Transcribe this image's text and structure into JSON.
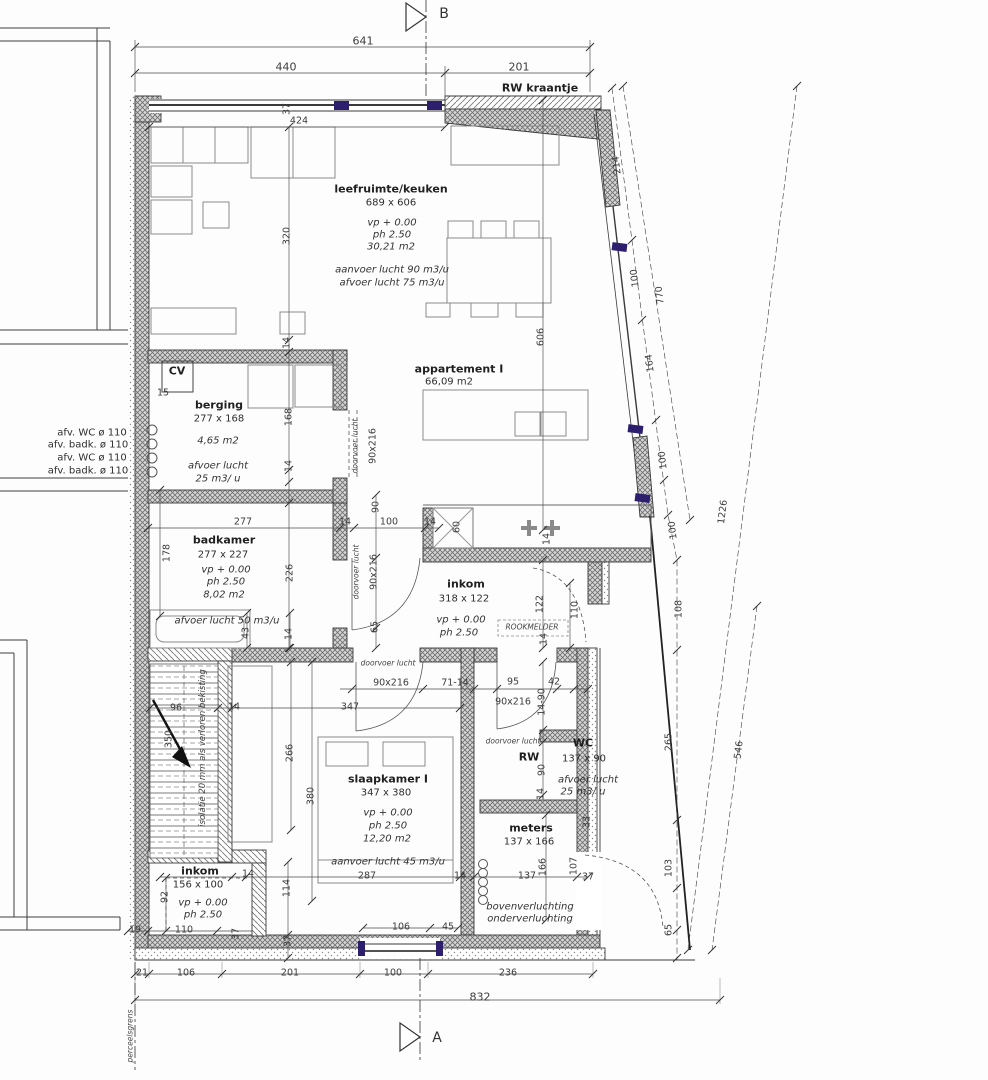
{
  "drawing": {
    "section_marker_top": "B",
    "section_marker_bottom": "A",
    "colors": {
      "accent_window": "#2d1f6e",
      "line": "#3a3a3a",
      "wall_hatch": "#9a9a9a"
    }
  },
  "rooms": {
    "leefruimte_keuken": {
      "title": "leefruimte/keuken",
      "size": "689 x 606",
      "vp": "vp + 0.00",
      "ph": "ph 2.50",
      "area": "30,21 m2",
      "supply": "aanvoer lucht 90 m3/u",
      "extract": "afvoer lucht 75 m3/u"
    },
    "appartement": {
      "title": "appartement I",
      "area": "66,09 m2"
    },
    "berging": {
      "title": "berging",
      "size": "277 x 168",
      "area": "4,65 m2",
      "extract1": "afvoer lucht",
      "extract2": "25 m3/ u",
      "cv": "CV",
      "cv_dim": "15"
    },
    "badkamer": {
      "title": "badkamer",
      "size": "277 x 227",
      "vp": "vp + 0.00",
      "ph": "ph 2.50",
      "area": "8,02 m2",
      "extract": "afvoer lucht 50 m3/u"
    },
    "inkom": {
      "title": "inkom",
      "size": "318 x 122",
      "vp": "vp + 0.00",
      "ph": "ph 2.50",
      "smoke_detector": "ROOKMELDER"
    },
    "slaapkamer": {
      "title": "slaapkamer I",
      "size": "347 x 380",
      "vp": "vp + 0.00",
      "ph": "ph 2.50",
      "area": "12,20 m2",
      "supply": "aanvoer lucht 45 m3/u"
    },
    "wc": {
      "title": "WC",
      "size": "137 x 90",
      "rw": "RW",
      "extract1": "afvoer lucht",
      "extract2": "25 m3/ u"
    },
    "meters": {
      "title": "meters",
      "size": "137 x 166"
    },
    "inkom_beneden": {
      "title": "inkom",
      "size": "156 x 100",
      "vp": "vp + 0.00",
      "ph": "ph 2.50"
    },
    "ventilation_note": [
      "bovenverluchting",
      "onderverluchting"
    ]
  },
  "notes": {
    "rw_kraantje": "RW kraantje",
    "stair_insulation": "isolatie 20 mm als verloren bekisting",
    "boundary": "perceelsgrens",
    "pipes": [
      "afv. WC ø 110",
      "afv. badk. ø 110",
      "afv. WC ø 110",
      "afv. badk. ø 110"
    ]
  },
  "labels": [
    {
      "name": "section-b-letter",
      "text": "B",
      "x": 444,
      "y": 14,
      "cls": "mark"
    },
    {
      "name": "dim-641",
      "text": "641",
      "x": 363,
      "y": 42,
      "cls": "dim big"
    },
    {
      "name": "dim-440",
      "text": "440",
      "x": 286,
      "y": 68,
      "cls": "dim big"
    },
    {
      "name": "dim-201-top",
      "text": "201",
      "x": 519,
      "y": 68,
      "cls": "dim big"
    },
    {
      "name": "note-rw-kraantje",
      "text": "RW kraantje",
      "x": 540,
      "y": 89,
      "cls": "b"
    },
    {
      "name": "dim-37-topleft",
      "text": "37",
      "x": 288,
      "y": 109,
      "cls": "dim rot"
    },
    {
      "name": "dim-424",
      "text": "424",
      "x": 299,
      "y": 122,
      "cls": "dim"
    },
    {
      "name": "dim-320",
      "text": "320",
      "x": 288,
      "y": 236,
      "cls": "dim rot"
    },
    {
      "name": "dim-14-a",
      "text": "14",
      "x": 288,
      "y": 343,
      "cls": "dim rot"
    },
    {
      "name": "dim-606",
      "text": "606",
      "x": 542,
      "y": 337,
      "cls": "dim rot"
    },
    {
      "name": "room-leefruimte-title",
      "text": "leefruimte/keuken",
      "x": 391,
      "y": 190,
      "cls": "b"
    },
    {
      "name": "room-leefruimte-size",
      "text": "689 x 606",
      "x": 391,
      "y": 203,
      "cls": "n"
    },
    {
      "name": "room-leefruimte-vp",
      "text": "vp + 0.00",
      "x": 392,
      "y": 223,
      "cls": "i"
    },
    {
      "name": "room-leefruimte-ph",
      "text": "ph 2.50",
      "x": 392,
      "y": 235,
      "cls": "i"
    },
    {
      "name": "room-leefruimte-area",
      "text": "30,21 m2",
      "x": 391,
      "y": 247,
      "cls": "i"
    },
    {
      "name": "room-leefruimte-supply",
      "text": "aanvoer lucht 90 m3/u",
      "x": 392,
      "y": 270,
      "cls": "i"
    },
    {
      "name": "room-leefruimte-extract",
      "text": "afvoer lucht 75 m3/u",
      "x": 392,
      "y": 283,
      "cls": "i"
    },
    {
      "name": "room-appartement-title",
      "text": "appartement I",
      "x": 459,
      "y": 370,
      "cls": "b"
    },
    {
      "name": "room-appartement-area",
      "text": "66,09 m2",
      "x": 449,
      "y": 382,
      "cls": "n"
    },
    {
      "name": "dim-214",
      "text": "214",
      "x": 618,
      "y": 165,
      "cls": "dim rotd1"
    },
    {
      "name": "dim-100-r1",
      "text": "100",
      "x": 636,
      "y": 278,
      "cls": "dim rotd1"
    },
    {
      "name": "dim-770",
      "text": "770",
      "x": 661,
      "y": 295,
      "cls": "dim rotd1"
    },
    {
      "name": "dim-164",
      "text": "164",
      "x": 651,
      "y": 363,
      "cls": "dim rotd1"
    },
    {
      "name": "dim-100-r2",
      "text": "100",
      "x": 664,
      "y": 460,
      "cls": "dim rotd1"
    },
    {
      "name": "dim-100-r3",
      "text": "100",
      "x": 674,
      "y": 530,
      "cls": "dim rotd1"
    },
    {
      "name": "dim-108",
      "text": "108",
      "x": 680,
      "y": 609,
      "cls": "dim rot"
    },
    {
      "name": "dim-1226",
      "text": "1226",
      "x": 724,
      "y": 512,
      "cls": "dim rotd2"
    },
    {
      "name": "dim-265",
      "text": "265",
      "x": 670,
      "y": 742,
      "cls": "dim rot"
    },
    {
      "name": "dim-546",
      "text": "546",
      "x": 740,
      "y": 750,
      "cls": "dim rotd2"
    },
    {
      "name": "dim-103",
      "text": "103",
      "x": 670,
      "y": 868,
      "cls": "dim rot"
    },
    {
      "name": "dim-65-r",
      "text": "65",
      "x": 670,
      "y": 930,
      "cls": "dim rot"
    },
    {
      "name": "pipe-label-1",
      "text": "afv. WC ø 110",
      "x": 92,
      "y": 433,
      "cls": "n"
    },
    {
      "name": "pipe-label-2",
      "text": "afv. badk. ø 110",
      "x": 88,
      "y": 445,
      "cls": "n"
    },
    {
      "name": "pipe-label-3",
      "text": "afv. WC ø 110",
      "x": 92,
      "y": 458,
      "cls": "n"
    },
    {
      "name": "pipe-label-4",
      "text": "afv. badk. ø 110",
      "x": 88,
      "y": 471,
      "cls": "n"
    },
    {
      "name": "label-cv",
      "text": "CV",
      "x": 177,
      "y": 372,
      "cls": "b"
    },
    {
      "name": "dim-15",
      "text": "15",
      "x": 163,
      "y": 394,
      "cls": "dim"
    },
    {
      "name": "room-berging-title",
      "text": "berging",
      "x": 219,
      "y": 406,
      "cls": "b"
    },
    {
      "name": "room-berging-size",
      "text": "277 x 168",
      "x": 219,
      "y": 419,
      "cls": "n"
    },
    {
      "name": "room-berging-area",
      "text": "4,65 m2",
      "x": 218,
      "y": 441,
      "cls": "i"
    },
    {
      "name": "room-berging-extract1",
      "text": "afvoer lucht",
      "x": 218,
      "y": 466,
      "cls": "i"
    },
    {
      "name": "room-berging-extract2",
      "text": "25 m3/ u",
      "x": 218,
      "y": 479,
      "cls": "i"
    },
    {
      "name": "dim-168",
      "text": "168",
      "x": 290,
      "y": 417,
      "cls": "dim rot"
    },
    {
      "name": "dim-14-b",
      "text": "14",
      "x": 290,
      "y": 466,
      "cls": "dim rot"
    },
    {
      "name": "note-doorvoer-berging",
      "text": "doorvoer lucht",
      "x": 356,
      "y": 446,
      "cls": "tiny rot"
    },
    {
      "name": "dim-door-berging",
      "text": "90x216",
      "x": 374,
      "y": 446,
      "cls": "dim rot"
    },
    {
      "name": "dim-178",
      "text": "178",
      "x": 168,
      "y": 553,
      "cls": "dim rot"
    },
    {
      "name": "dim-277",
      "text": "277",
      "x": 243,
      "y": 523,
      "cls": "dim"
    },
    {
      "name": "dim-14-c",
      "text": "14",
      "x": 345,
      "y": 523,
      "cls": "dim"
    },
    {
      "name": "dim-100-bad",
      "text": "100",
      "x": 389,
      "y": 523,
      "cls": "dim"
    },
    {
      "name": "dim-14-d",
      "text": "14",
      "x": 430,
      "y": 523,
      "cls": "dim"
    },
    {
      "name": "room-badkamer-title",
      "text": "badkamer",
      "x": 224,
      "y": 541,
      "cls": "b"
    },
    {
      "name": "room-badkamer-size",
      "text": "277 x 227",
      "x": 223,
      "y": 555,
      "cls": "n"
    },
    {
      "name": "room-badkamer-vp",
      "text": "vp + 0.00",
      "x": 226,
      "y": 570,
      "cls": "i"
    },
    {
      "name": "room-badkamer-ph",
      "text": "ph 2.50",
      "x": 226,
      "y": 582,
      "cls": "i"
    },
    {
      "name": "room-badkamer-area",
      "text": "8,02 m2",
      "x": 224,
      "y": 595,
      "cls": "i"
    },
    {
      "name": "room-badkamer-extract",
      "text": "afvoer lucht 50 m3/u",
      "x": 227,
      "y": 621,
      "cls": "i"
    },
    {
      "name": "dim-226",
      "text": "226",
      "x": 291,
      "y": 573,
      "cls": "dim rot"
    },
    {
      "name": "note-doorvoer-badkamer",
      "text": "doorvoer lucht",
      "x": 357,
      "y": 572,
      "cls": "tiny rot"
    },
    {
      "name": "dim-door-badkamer",
      "text": "90x216",
      "x": 375,
      "y": 572,
      "cls": "dim rot"
    },
    {
      "name": "dim-90-kitchen",
      "text": "90",
      "x": 377,
      "y": 507,
      "cls": "dim rot"
    },
    {
      "name": "dim-65-hall",
      "text": "65",
      "x": 376,
      "y": 627,
      "cls": "dim rot"
    },
    {
      "name": "dim-60-sink",
      "text": "60",
      "x": 458,
      "y": 527,
      "cls": "dim rot"
    },
    {
      "name": "dim-14-stove",
      "text": "14",
      "x": 548,
      "y": 539,
      "cls": "dim rot"
    },
    {
      "name": "room-inkom-title",
      "text": "inkom",
      "x": 466,
      "y": 585,
      "cls": "b"
    },
    {
      "name": "room-inkom-size",
      "text": "318 x 122",
      "x": 464,
      "y": 599,
      "cls": "n"
    },
    {
      "name": "room-inkom-vp",
      "text": "vp + 0.00",
      "x": 461,
      "y": 620,
      "cls": "i"
    },
    {
      "name": "room-inkom-ph",
      "text": "ph 2.50",
      "x": 459,
      "y": 633,
      "cls": "i"
    },
    {
      "name": "note-rookmelder",
      "text": "ROOKMELDER",
      "x": 532,
      "y": 628,
      "cls": "tiny"
    },
    {
      "name": "dim-122",
      "text": "122",
      "x": 541,
      "y": 604,
      "cls": "dim rot"
    },
    {
      "name": "dim-110-inkom",
      "text": "110",
      "x": 576,
      "y": 610,
      "cls": "dim rot"
    },
    {
      "name": "dim-14-e",
      "text": "14",
      "x": 545,
      "y": 639,
      "cls": "dim rot"
    },
    {
      "name": "note-doorvoer-slaapkamer",
      "text": "doorvoer lucht",
      "x": 388,
      "y": 664,
      "cls": "tiny"
    },
    {
      "name": "dim-door-slaapkamer",
      "text": "90x216",
      "x": 391,
      "y": 684,
      "cls": "dim"
    },
    {
      "name": "dim-71-14",
      "text": "71-14",
      "x": 455,
      "y": 684,
      "cls": "dim"
    },
    {
      "name": "dim-95",
      "text": "95",
      "x": 513,
      "y": 683,
      "cls": "dim"
    },
    {
      "name": "dim-42",
      "text": "42",
      "x": 554,
      "y": 683,
      "cls": "dim"
    },
    {
      "name": "dim-door-wc",
      "text": "90x216",
      "x": 513,
      "y": 703,
      "cls": "dim"
    },
    {
      "name": "dim-14-90",
      "text": "14-90",
      "x": 543,
      "y": 702,
      "cls": "dim rot"
    },
    {
      "name": "note-doorvoer-wc",
      "text": "doorvoer lucht",
      "x": 513,
      "y": 742,
      "cls": "tiny"
    },
    {
      "name": "room-wc-title",
      "text": "WC",
      "x": 583,
      "y": 744,
      "cls": "b"
    },
    {
      "name": "label-rw",
      "text": "RW",
      "x": 529,
      "y": 758,
      "cls": "b"
    },
    {
      "name": "room-wc-size",
      "text": "137 x 90",
      "x": 584,
      "y": 759,
      "cls": "n"
    },
    {
      "name": "dim-90-wc",
      "text": "90",
      "x": 543,
      "y": 770,
      "cls": "dim rot"
    },
    {
      "name": "room-wc-extract1",
      "text": "afvoer lucht",
      "x": 588,
      "y": 780,
      "cls": "i"
    },
    {
      "name": "room-wc-extract2",
      "text": "25 m3/ u",
      "x": 583,
      "y": 792,
      "cls": "i"
    },
    {
      "name": "dim-14-f",
      "text": "14",
      "x": 542,
      "y": 794,
      "cls": "dim rot"
    },
    {
      "name": "room-meters-title",
      "text": "meters",
      "x": 531,
      "y": 829,
      "cls": "b"
    },
    {
      "name": "room-meters-size",
      "text": "137 x 166",
      "x": 529,
      "y": 842,
      "cls": "n"
    },
    {
      "name": "dim-33",
      "text": "33",
      "x": 588,
      "y": 822,
      "cls": "dim rot"
    },
    {
      "name": "note-isolatie",
      "text": "isolatie 20 mm als verloren bekisting",
      "x": 204,
      "y": 748,
      "cls": "tiny iso rot"
    },
    {
      "name": "dim-96",
      "text": "96",
      "x": 176,
      "y": 709,
      "cls": "dim"
    },
    {
      "name": "dim-14-g",
      "text": "14",
      "x": 234,
      "y": 708,
      "cls": "dim"
    },
    {
      "name": "dim-347",
      "text": "347",
      "x": 350,
      "y": 708,
      "cls": "dim"
    },
    {
      "name": "dim-350",
      "text": "350",
      "x": 170,
      "y": 739,
      "cls": "dim rot"
    },
    {
      "name": "dim-43",
      "text": "43",
      "x": 247,
      "y": 633,
      "cls": "dim rot"
    },
    {
      "name": "dim-14-h",
      "text": "14",
      "x": 290,
      "y": 634,
      "cls": "dim rot"
    },
    {
      "name": "dim-266",
      "text": "266",
      "x": 291,
      "y": 753,
      "cls": "dim rot"
    },
    {
      "name": "dim-380",
      "text": "380",
      "x": 312,
      "y": 796,
      "cls": "dim rot"
    },
    {
      "name": "room-slaapkamer-title",
      "text": "slaapkamer I",
      "x": 388,
      "y": 780,
      "cls": "b"
    },
    {
      "name": "room-slaapkamer-size",
      "text": "347 x 380",
      "x": 386,
      "y": 793,
      "cls": "n"
    },
    {
      "name": "room-slaapkamer-vp",
      "text": "vp + 0.00",
      "x": 388,
      "y": 813,
      "cls": "i"
    },
    {
      "name": "room-slaapkamer-ph",
      "text": "ph 2.50",
      "x": 388,
      "y": 826,
      "cls": "i"
    },
    {
      "name": "room-slaapkamer-area",
      "text": "12,20 m2",
      "x": 387,
      "y": 839,
      "cls": "i"
    },
    {
      "name": "room-slaapkamer-supply",
      "text": "aanvoer lucht 45 m3/u",
      "x": 388,
      "y": 862,
      "cls": "i"
    },
    {
      "name": "room-inkom2-title",
      "text": "inkom",
      "x": 200,
      "y": 872,
      "cls": "b"
    },
    {
      "name": "room-inkom2-size",
      "text": "156 x 100",
      "x": 198,
      "y": 885,
      "cls": "n"
    },
    {
      "name": "room-inkom2-vp",
      "text": "vp + 0.00",
      "x": 203,
      "y": 903,
      "cls": "i"
    },
    {
      "name": "room-inkom2-ph",
      "text": "ph 2.50",
      "x": 203,
      "y": 915,
      "cls": "i"
    },
    {
      "name": "dim-92",
      "text": "92",
      "x": 166,
      "y": 897,
      "cls": "dim rot"
    },
    {
      "name": "dim-14-i",
      "text": "14",
      "x": 248,
      "y": 875,
      "cls": "dim"
    },
    {
      "name": "dim-114",
      "text": "114",
      "x": 288,
      "y": 888,
      "cls": "dim rot"
    },
    {
      "name": "dim-19",
      "text": "19",
      "x": 135,
      "y": 931,
      "cls": "dim"
    },
    {
      "name": "dim-110-b",
      "text": "110",
      "x": 184,
      "y": 931,
      "cls": "dim"
    },
    {
      "name": "dim-37-b",
      "text": "37",
      "x": 237,
      "y": 934,
      "cls": "dim rot"
    },
    {
      "name": "dim-37-c",
      "text": "37",
      "x": 289,
      "y": 941,
      "cls": "dim rot"
    },
    {
      "name": "dim-287",
      "text": "287",
      "x": 367,
      "y": 877,
      "cls": "dim"
    },
    {
      "name": "dim-14-j",
      "text": "14",
      "x": 460,
      "y": 877,
      "cls": "dim"
    },
    {
      "name": "dim-137",
      "text": "137",
      "x": 527,
      "y": 877,
      "cls": "dim"
    },
    {
      "name": "dim-166",
      "text": "166",
      "x": 544,
      "y": 867,
      "cls": "dim rot"
    },
    {
      "name": "dim-107",
      "text": "107",
      "x": 575,
      "y": 866,
      "cls": "dim rot"
    },
    {
      "name": "dim-37-d",
      "text": "37",
      "x": 588,
      "y": 878,
      "cls": "dim"
    },
    {
      "name": "dim-106-door",
      "text": "106",
      "x": 401,
      "y": 928,
      "cls": "dim"
    },
    {
      "name": "dim-45",
      "text": "45",
      "x": 448,
      "y": 928,
      "cls": "dim"
    },
    {
      "name": "note-bovenverluchting",
      "text": "bovenverluchting",
      "x": 530,
      "y": 907,
      "cls": "i"
    },
    {
      "name": "note-onderverluchting",
      "text": "onderverluchting",
      "x": 530,
      "y": 919,
      "cls": "i"
    },
    {
      "name": "dim-21",
      "text": "21",
      "x": 142,
      "y": 974,
      "cls": "dim"
    },
    {
      "name": "dim-106",
      "text": "106",
      "x": 186,
      "y": 974,
      "cls": "dim"
    },
    {
      "name": "dim-201",
      "text": "201",
      "x": 290,
      "y": 974,
      "cls": "dim"
    },
    {
      "name": "dim-100-bottom",
      "text": "100",
      "x": 393,
      "y": 974,
      "cls": "dim"
    },
    {
      "name": "dim-236",
      "text": "236",
      "x": 508,
      "y": 974,
      "cls": "dim"
    },
    {
      "name": "dim-832",
      "text": "832",
      "x": 480,
      "y": 998,
      "cls": "dim big"
    },
    {
      "name": "section-a-letter",
      "text": "A",
      "x": 437,
      "y": 1038,
      "cls": "mark"
    },
    {
      "name": "note-perceelsgrens",
      "text": "perceelsgrens",
      "x": 131,
      "y": 1036,
      "cls": "tiny rot"
    }
  ]
}
